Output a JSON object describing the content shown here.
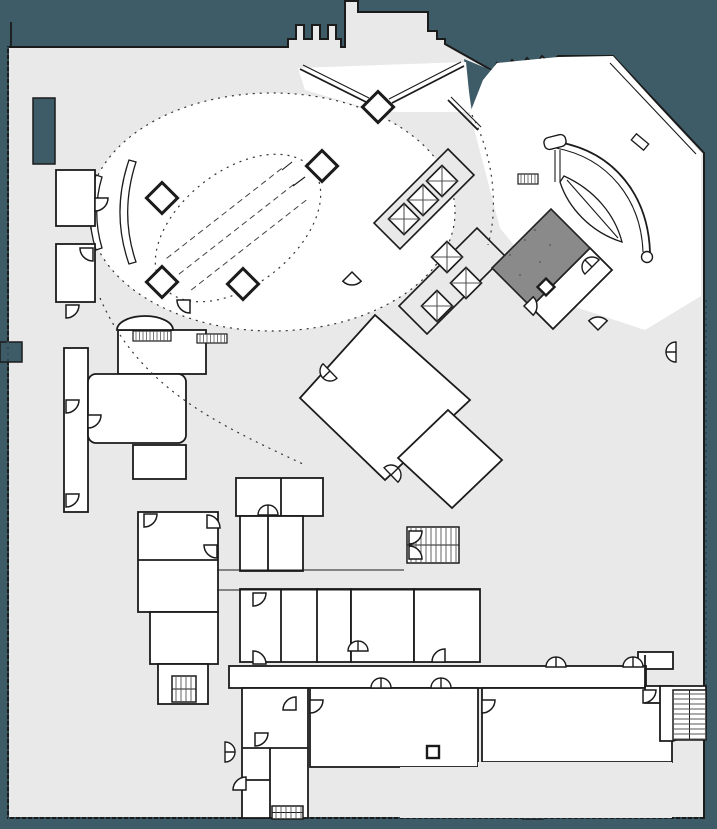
{
  "drawing": {
    "kind": "architectural-floor-plan",
    "level": "ground-floor-lobby",
    "visible_text": []
  },
  "colors": {
    "exterior": "#3E5C68",
    "footprint": "#E9E9E9",
    "room_white": "#FFFFFF",
    "wall": "#1B1B1B",
    "highlight_room": "#8A8A8A",
    "site_boundary": "#2E4953",
    "detail": "#555555"
  },
  "plan": {
    "columns": [
      {
        "x": 162,
        "y": 198,
        "s": 11,
        "shape": "diamond"
      },
      {
        "x": 162,
        "y": 282,
        "s": 11,
        "shape": "diamond"
      },
      {
        "x": 243,
        "y": 284,
        "s": 11,
        "shape": "diamond"
      },
      {
        "x": 322,
        "y": 166,
        "s": 11,
        "shape": "diamond"
      },
      {
        "x": 378,
        "y": 107,
        "s": 11,
        "shape": "diamond"
      },
      {
        "x": 546,
        "y": 287,
        "s": 6,
        "shape": "diamond"
      },
      {
        "x": 433,
        "y": 752,
        "s": 6,
        "shape": "square"
      }
    ],
    "elevator_cars": [
      {
        "x": 404,
        "y": 219
      },
      {
        "x": 423,
        "y": 200
      },
      {
        "x": 442,
        "y": 181
      },
      {
        "x": 447,
        "y": 257
      },
      {
        "x": 466,
        "y": 283
      },
      {
        "x": 437,
        "y": 306
      }
    ],
    "stairs": [
      {
        "x": 407,
        "y": 527,
        "w": 52,
        "h": 36,
        "dir": "v"
      },
      {
        "x": 172,
        "y": 676,
        "w": 24,
        "h": 26,
        "dir": "v"
      },
      {
        "x": 673,
        "y": 690,
        "w": 33,
        "h": 50,
        "dir": "h"
      },
      {
        "x": 272,
        "y": 806,
        "w": 31,
        "h": 13,
        "dir": "v"
      }
    ],
    "millwork_hatches": [
      {
        "x": 133,
        "y": 331,
        "w": 38,
        "h": 10
      },
      {
        "x": 197,
        "y": 334,
        "w": 30,
        "h": 9
      },
      {
        "x": 518,
        "y": 174,
        "w": 20,
        "h": 10
      }
    ],
    "door_arcs": [
      {
        "x": 95,
        "y": 198,
        "rot": 0
      },
      {
        "x": 66,
        "y": 305,
        "rot": 0
      },
      {
        "x": 66,
        "y": 400,
        "rot": 0
      },
      {
        "x": 66,
        "y": 494,
        "rot": 0
      },
      {
        "x": 190,
        "y": 300,
        "rot": 90
      },
      {
        "x": 144,
        "y": 514,
        "rot": 0
      },
      {
        "x": 207,
        "y": 528,
        "rot": 270
      },
      {
        "x": 253,
        "y": 593,
        "rot": 0
      },
      {
        "x": 253,
        "y": 664,
        "rot": 270
      },
      {
        "x": 409,
        "y": 531,
        "rot": 0
      },
      {
        "x": 409,
        "y": 559,
        "rot": 270
      },
      {
        "x": 643,
        "y": 690,
        "rot": 0
      },
      {
        "x": 296,
        "y": 710,
        "rot": 180
      },
      {
        "x": 255,
        "y": 733,
        "rot": 0
      },
      {
        "x": 246,
        "y": 790,
        "rot": 180
      },
      {
        "x": 524,
        "y": 306,
        "rot": 315
      },
      {
        "x": 352,
        "y": 272,
        "rot": 45
      },
      {
        "x": 598,
        "y": 330,
        "rot": 225
      },
      {
        "x": 445,
        "y": 662,
        "rot": 180
      },
      {
        "x": 88,
        "y": 415,
        "rot": 0
      },
      {
        "x": 217,
        "y": 545,
        "rot": 90
      },
      {
        "x": 310,
        "y": 700,
        "rot": 0
      },
      {
        "x": 482,
        "y": 700,
        "rot": 0
      },
      {
        "x": 93,
        "y": 248,
        "rot": 90
      }
    ],
    "double_doors": [
      {
        "x": 268,
        "y": 515,
        "rot": 0
      },
      {
        "x": 358,
        "y": 651,
        "rot": 0
      },
      {
        "x": 381,
        "y": 688,
        "rot": 0
      },
      {
        "x": 441,
        "y": 688,
        "rot": 0
      },
      {
        "x": 556,
        "y": 667,
        "rot": 0
      },
      {
        "x": 633,
        "y": 667,
        "rot": 0
      },
      {
        "x": 225,
        "y": 752,
        "rot": 90
      },
      {
        "x": 330,
        "y": 371,
        "rot": 226
      },
      {
        "x": 391,
        "y": 475,
        "rot": 46
      },
      {
        "x": 592,
        "y": 267,
        "rot": 315
      },
      {
        "x": 676,
        "y": 352,
        "rot": 270
      }
    ]
  }
}
